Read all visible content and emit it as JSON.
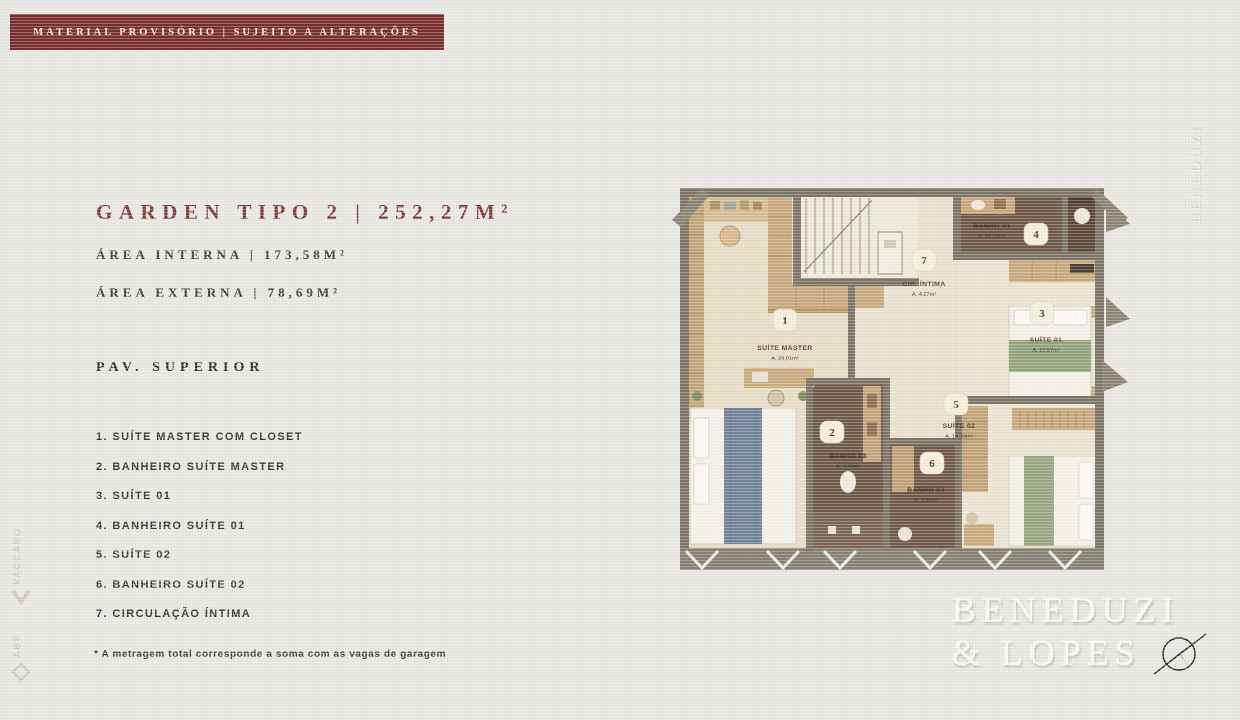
{
  "banner": {
    "text": "MATERIAL PROVISÓRIO | SUJEITO A ALTERAÇÕES"
  },
  "header": {
    "title": "GARDEN TIPO 2 | 252,27M²",
    "area_interna": "ÁREA INTERNA | 173,58M²",
    "area_externa": "ÁREA EXTERNA | 78,69M²",
    "floor_label": "PAV. SUPERIOR"
  },
  "legend": {
    "items": [
      "1. SUÍTE MASTER COM CLOSET",
      "2. BANHEIRO SUÍTE MASTER",
      "3. SUÍTE 01",
      "4. BANHEIRO SUÍTE 01",
      "5. SUÍTE 02",
      "6. BANHEIRO SUÍTE 02",
      "7. CIRCULAÇÃO ÍNTIMA"
    ]
  },
  "footnote": "* A metragem total corresponde a soma com as vagas de garagem",
  "plan": {
    "rooms": [
      {
        "badge": "1",
        "name": "SUÍTE MASTER",
        "area": "A. 29,01m²"
      },
      {
        "badge": "2",
        "name": "BANHO 03",
        "area": "A. 5,99m²"
      },
      {
        "badge": "3",
        "name": "SUÍTE 01",
        "area": "A. 10,57m²"
      },
      {
        "badge": "4",
        "name": "BANHO 01",
        "area": "A. 04,09m²"
      },
      {
        "badge": "5",
        "name": "SUÍTE 02",
        "area": "A. 14,23m²"
      },
      {
        "badge": "6",
        "name": "BANHO 02",
        "area": "A. 3,99m²"
      },
      {
        "badge": "7",
        "name": "CIR. ÍNTIMA",
        "area": "A. 4,27m²"
      }
    ]
  },
  "brand": {
    "line1": "BENEDUZI",
    "line2": "& LOPES"
  },
  "watermarks": {
    "right": "BENEDUZI",
    "left_top": "VACCARO",
    "left_bottom": "ABF"
  },
  "icons": {
    "compass": "compass-rose",
    "left_top_mark": "chevron",
    "left_bottom_mark": "diamond"
  },
  "colors": {
    "background": "#e9e7e2",
    "banner": "#772e2b",
    "title": "#7d3b36",
    "text": "#34322f",
    "plan_wall": "#7b7467",
    "plan_floor": "#ece4d2",
    "plan_wood": "#c8a97e",
    "plan_bath": "#6d5746",
    "badge_bg": "#f6eedd",
    "badge_text": "#5a2b1f"
  }
}
